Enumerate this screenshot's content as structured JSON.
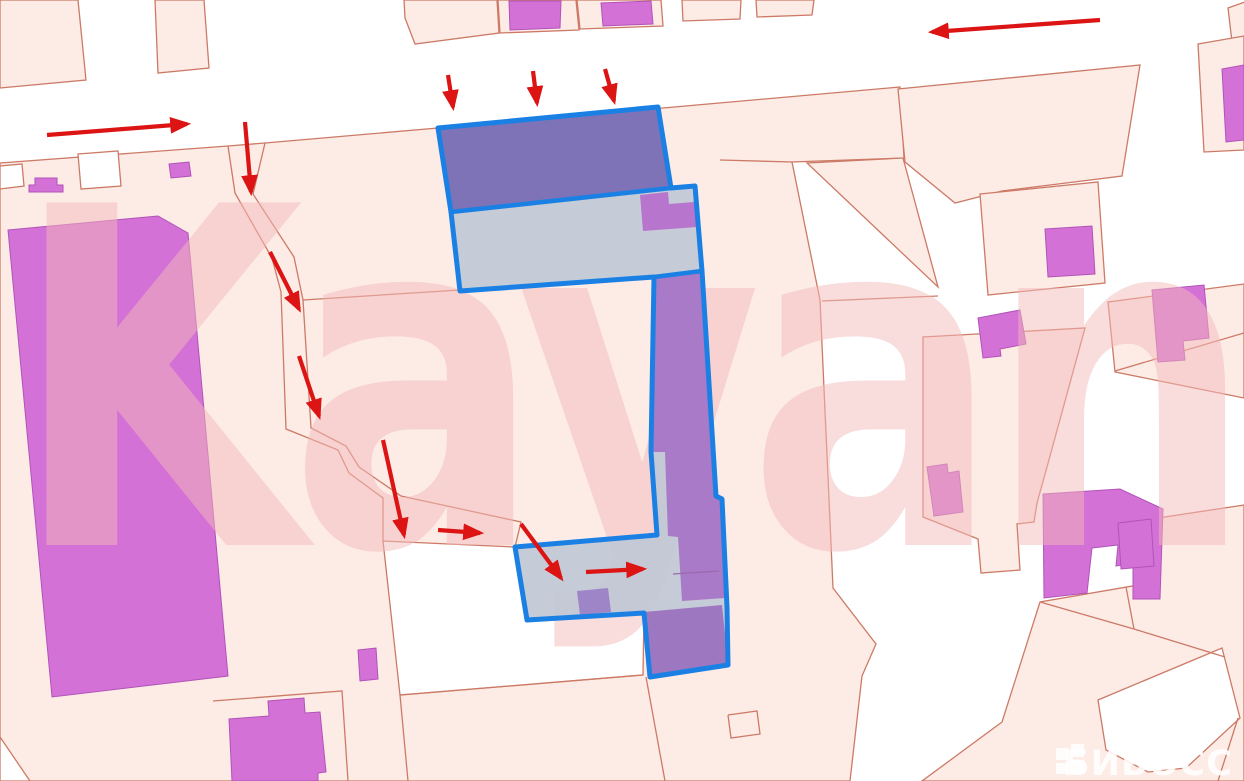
{
  "meta": {
    "width": 1244,
    "height": 781,
    "app": "cadastral-map-view"
  },
  "watermark": {
    "text": "Kayan"
  },
  "brand": {
    "text": "БИБОСС"
  },
  "colors": {
    "background": "#ffffff",
    "parcel_fill": "#fdebe6",
    "parcel_line": "#cc7a66",
    "building_fill": "#d471d6",
    "building_stroke": "#b153b8",
    "selection_blue": "#1b80e4",
    "selection_gray": "rgba(189,199,213,0.88)",
    "selection_violet": "rgba(113,99,178,0.85)",
    "selection_purple": "rgba(165,113,198,0.9)",
    "selection_purple_dark": "rgba(150,103,189,0.85)",
    "selection_purple_bright": "rgba(183,112,204,0.95)",
    "selection_square": "rgba(148,116,196,0.8)",
    "thin_divider": "#9a6aae",
    "arrow_red": "#dc1414",
    "watermark_pink": "rgba(244,185,185,0.5)",
    "brand_white": "rgba(255,255,255,0.88)"
  },
  "map": {
    "parcels": [
      {
        "name": "parcel",
        "pts": "0,0 78,0 86,80 0,88"
      },
      {
        "name": "parcel",
        "pts": "155,0 204,0 209,68 158,73"
      },
      {
        "name": "parcel",
        "pts": "404,0 497,0 499,33 415,44 405,18"
      },
      {
        "name": "parcel",
        "pts": "498,0 576,0 579,30 500,33"
      },
      {
        "name": "parcel",
        "pts": "577,0 661,0 663,26 580,29"
      },
      {
        "name": "parcel",
        "pts": "682,0 741,0 740,19 683,21"
      },
      {
        "name": "parcel",
        "pts": "756,0 814,0 812,15 757,17"
      },
      {
        "name": "parcel",
        "pts": "1228,8 1245,2 1245,40 1232,42"
      },
      {
        "name": "parcel-field",
        "pts": "0,163 228,146 265,143 438,128 663,108 900,87 904,158 792,162 820,300 833,588 876,644 862,676 850,781 0,781"
      },
      {
        "name": "parcel",
        "pts": "807,163 903,158 938,287"
      },
      {
        "name": "parcel",
        "pts": "898,89 1140,65 1122,176 1002,191 955,203 905,162"
      },
      {
        "name": "parcel",
        "pts": "980,194 1098,182 1105,283 988,295"
      },
      {
        "name": "parcel",
        "pts": "1198,44 1244,36 1244,150 1204,152"
      },
      {
        "name": "parcel",
        "pts": "1108,302 1244,284 1244,398 1115,372"
      },
      {
        "name": "parcel",
        "pts": "923,337 1085,328 1047,467 1037,503 1034,522 1017,524 1020,570 981,573 978,539 923,517"
      },
      {
        "name": "parcel",
        "pts": "1158,518 1244,505 1244,781 922,781 1002,722 1040,602 1138,585"
      },
      {
        "name": "parcel-white",
        "pts": "0,166 22,164 24,186 0,189",
        "white": true
      },
      {
        "name": "parcel-white",
        "pts": "78,154 118,151 121,186 81,189",
        "white": true
      },
      {
        "name": "parcel-white",
        "pts": "1098,700 1222,648 1240,718 1186,768 1148,772 1106,750",
        "white": true
      }
    ],
    "white_areas": [
      {
        "name": "open-area",
        "pts": "383,541 515,547 527,620 644,613 643,675 400,695"
      },
      {
        "name": "open-area",
        "pts": "0,737 30,781 0,781"
      }
    ],
    "lines": [
      {
        "name": "boundary-line",
        "pts": "228,146 235,193 272,258 281,292 286,429 338,450 349,473 383,498 383,541"
      },
      {
        "name": "boundary-line",
        "pts": "265,143 253,194 294,257 303,300 311,428 346,446 359,467 401,496 521,522 515,547"
      },
      {
        "name": "boundary-line",
        "pts": "303,300 460,290"
      },
      {
        "name": "boundary-line",
        "pts": "720,160 792,162"
      },
      {
        "name": "boundary-line",
        "pts": "822,301 938,296"
      },
      {
        "name": "boundary-line",
        "pts": "400,695 643,675"
      },
      {
        "name": "boundary-line",
        "pts": "646,677 665,781"
      },
      {
        "name": "boundary-line",
        "pts": "400,695 408,781"
      },
      {
        "name": "boundary-line",
        "pts": "1040,602 1134,629 1225,657"
      },
      {
        "name": "boundary-line",
        "pts": "1134,629 1126,587"
      },
      {
        "name": "boundary-line",
        "pts": "1115,371 1244,333"
      },
      {
        "name": "boundary-line",
        "pts": "728,715 757,711 760,734 731,738 728,715"
      },
      {
        "name": "boundary-line",
        "pts": "213,701 342,691 348,781"
      },
      {
        "name": "boundary-line",
        "pts": "1238,718 1218,781"
      }
    ],
    "buildings": [
      {
        "name": "building",
        "pts": "29,192 29,185 35,185 35,178 57,178 57,185 63,185 63,192"
      },
      {
        "name": "building",
        "pts": "169,164 189,162 191,176 171,178"
      },
      {
        "name": "building",
        "pts": "509,1 561,1 560,28 510,30"
      },
      {
        "name": "building",
        "pts": "601,3 651,1 653,24 603,26"
      },
      {
        "name": "building-large",
        "pts": "8,230 158,216 188,233 228,676 52,697"
      },
      {
        "name": "building",
        "pts": "229,719 269,716 268,701 304,698 305,713 320,712 326,772 318,773 318,781 232,781"
      },
      {
        "name": "building",
        "pts": "358,650 376,648 378,679 360,681"
      },
      {
        "name": "building",
        "pts": "1045,229 1092,226 1095,274 1048,277"
      },
      {
        "name": "building",
        "pts": "978,318 1020,310 1026,344 1000,349 1001,356 983,358"
      },
      {
        "name": "building",
        "pts": "927,467 947,464 948,473 959,471 963,512 934,516"
      },
      {
        "name": "building",
        "pts": "1152,290 1204,285 1209,338 1183,341 1185,360 1158,362"
      },
      {
        "name": "building",
        "pts": "1222,69 1244,65 1244,140 1226,142"
      },
      {
        "name": "building-large",
        "pts": "1043,494 1120,489 1163,509 1160,599 1133,599 1133,563 1116,566 1118,545 1092,548 1087,593 1044,598"
      },
      {
        "name": "building",
        "pts": "1118,523 1151,519 1154,566 1121,569"
      }
    ],
    "selection": {
      "outline": "438,128 658,107 671,188 695,186 702,271 716,496 722,499 727,607 728,665 650,677 644,613 527,620 515,547 657,535 651,452 654,277 460,291 451,212",
      "fills": [
        {
          "name": "selection-building-violet",
          "pts": "438,128 658,107 671,188 451,212",
          "color": "selection_violet"
        },
        {
          "name": "selection-building-strip",
          "pts": "655,277 702,272 716,496 722,499 725,598 682,601 678,537 668,536 665,452 652,452",
          "color": "selection_purple"
        },
        {
          "name": "selection-building-bottom",
          "pts": "644,612 722,605 728,664 650,676",
          "color": "selection_purple_dark"
        },
        {
          "name": "selection-building-corner",
          "pts": "640,195 668,192 669,204 694,202 697,227 643,231",
          "color": "selection_purple_bright"
        },
        {
          "name": "selection-building-small",
          "pts": "577,591 608,588 611,612 580,615",
          "color": "selection_square"
        }
      ],
      "dividers": [
        {
          "pts": "451,212 671,188"
        },
        {
          "pts": "654,277 702,271"
        }
      ],
      "thin_lines": [
        {
          "pts": "673,574 719,571"
        }
      ]
    },
    "arrows": [
      {
        "x1": 47,
        "y1": 135,
        "x2": 187,
        "y2": 124
      },
      {
        "x1": 245,
        "y1": 122,
        "x2": 251,
        "y2": 192
      },
      {
        "x1": 448,
        "y1": 75,
        "x2": 453,
        "y2": 107
      },
      {
        "x1": 533,
        "y1": 71,
        "x2": 537,
        "y2": 103
      },
      {
        "x1": 605,
        "y1": 69,
        "x2": 614,
        "y2": 101
      },
      {
        "x1": 1100,
        "y1": 20,
        "x2": 932,
        "y2": 32
      },
      {
        "x1": 270,
        "y1": 252,
        "x2": 299,
        "y2": 309
      },
      {
        "x1": 299,
        "y1": 356,
        "x2": 319,
        "y2": 416
      },
      {
        "x1": 383,
        "y1": 440,
        "x2": 404,
        "y2": 535
      },
      {
        "x1": 438,
        "y1": 530,
        "x2": 480,
        "y2": 533
      },
      {
        "x1": 521,
        "y1": 524,
        "x2": 561,
        "y2": 578
      },
      {
        "x1": 586,
        "y1": 572,
        "x2": 643,
        "y2": 569
      }
    ]
  }
}
